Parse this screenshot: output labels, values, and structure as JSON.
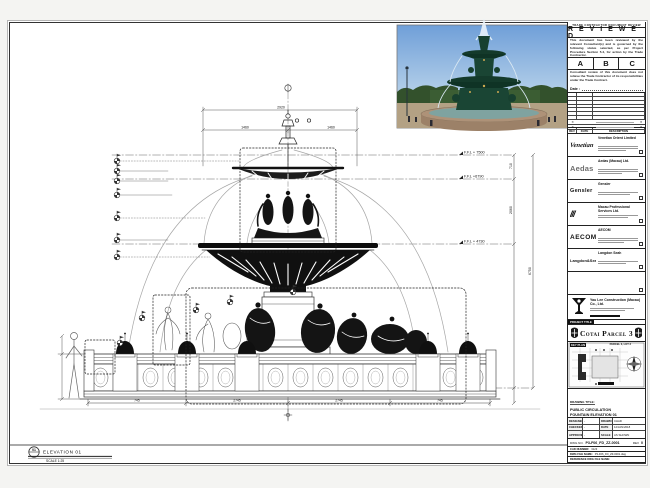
{
  "sheet": {
    "elevation": {
      "bubble": "01",
      "label": "ELEVATION 01",
      "scale": "SCALE 1:25"
    }
  },
  "drawing": {
    "levels": [
      {
        "label": "F.F.L + 7500"
      },
      {
        "label": "F.F.L +6790"
      },
      {
        "label": "F.F.L + 4730"
      },
      {
        "label": "F.F.L +750"
      }
    ],
    "vertical_dims": [
      "710",
      "2060",
      "6750"
    ],
    "top_dims": [
      "2920",
      "1460",
      "1460"
    ],
    "bottom_dims": [
      "745",
      "2745",
      "2745",
      "745"
    ]
  },
  "stamp": {
    "top_note": "TRADE CONTRACTOR DOCUMENT REVIEW",
    "title": "R E V I E W E D",
    "para1": "This document has been reviewed by the relevant Consultant(s) and is governed by the following status selected, as per Project Procedure Section 5.4, for action by the Trade Contractor.",
    "options": [
      "A",
      "B",
      "C"
    ],
    "para2": "Consultant review of this document does not relieve the Trade Contractor of its responsibilities under the Trade Contract.",
    "date_label": "Date :"
  },
  "revision_table": {
    "headers": [
      "REV",
      "DATE",
      "DESCRIPTION"
    ],
    "mark": "✕"
  },
  "consultants": [
    {
      "logo": "Venetian",
      "name": "Venetian Orient Limited"
    },
    {
      "logo": "Aedas",
      "name": "Aedas (Macau) Ltd."
    },
    {
      "logo": "Gensler",
      "name": "Gensler"
    },
    {
      "logo": "///",
      "name": "Macau Professional Services Ltd."
    },
    {
      "logo": "AECOM",
      "name": "AECOM"
    },
    {
      "logo": "Langdon&Seah",
      "name": "Langdon Seah"
    },
    {
      "logo": "",
      "name": ""
    }
  ],
  "contractor": {
    "name": "Yau Lee Construction (Macau) Co., Ltd."
  },
  "project": {
    "label": "PROJECT TITLE",
    "title": "Cotai Parcel 3"
  },
  "key_plan": {
    "label": "KEY PLAN",
    "sub": "PARCEL 3, LOT 3"
  },
  "title_block": {
    "drawing_title_label": "DRAWING TITLE:",
    "title_lines": [
      "PUBLIC CIRCULATION",
      "FOUNTAIN ELEVATION 01",
      "FOR FRP DRAWING"
    ],
    "fields": [
      {
        "label": "DESIGNED",
        "value": "-"
      },
      {
        "label": "DRAWN",
        "value": "CHAD"
      },
      {
        "label": "CHECKED",
        "value": "-"
      },
      {
        "label": "DATE",
        "value": "12/JAN/2018"
      },
      {
        "label": "APPROVED",
        "value": "-"
      },
      {
        "label": "SCALE",
        "value": "AS SHOWN"
      }
    ],
    "dwg_no_label": "DWG NO.",
    "dwg_no": "P3-F06_FD_ZZ-0001",
    "rev_label": "REV",
    "rev": "0",
    "cad_label": "CAD NUMBER:",
    "cad": "3123",
    "file_label": "DWG FILE NAME:",
    "file": "P3-F06_FD_ZZ-0001.dwg",
    "ref_label": "REFERENCE DWG FILE NAME:"
  }
}
